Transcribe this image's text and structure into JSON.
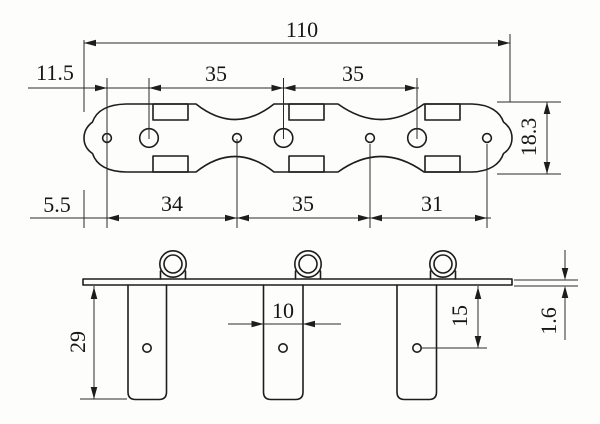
{
  "drawing": {
    "type": "technical-dimension-drawing",
    "subject": "3-in-line tuner mounting plate, top view and side elevation",
    "background_color": "#fdfdfc",
    "line_color": "#1d1d1d"
  },
  "dims": {
    "overall_length": "110",
    "end_to_first_hole": "11.5",
    "post_pitch_1": "35",
    "post_pitch_2": "35",
    "plate_width": "18.3",
    "end_to_screw_hole": "5.5",
    "screw_pitch_1": "34",
    "screw_pitch_2": "35",
    "screw_pitch_3": "31",
    "housing_length": "29",
    "housing_width": "10",
    "hole_to_plate": "15",
    "plate_thickness": "1.6"
  }
}
